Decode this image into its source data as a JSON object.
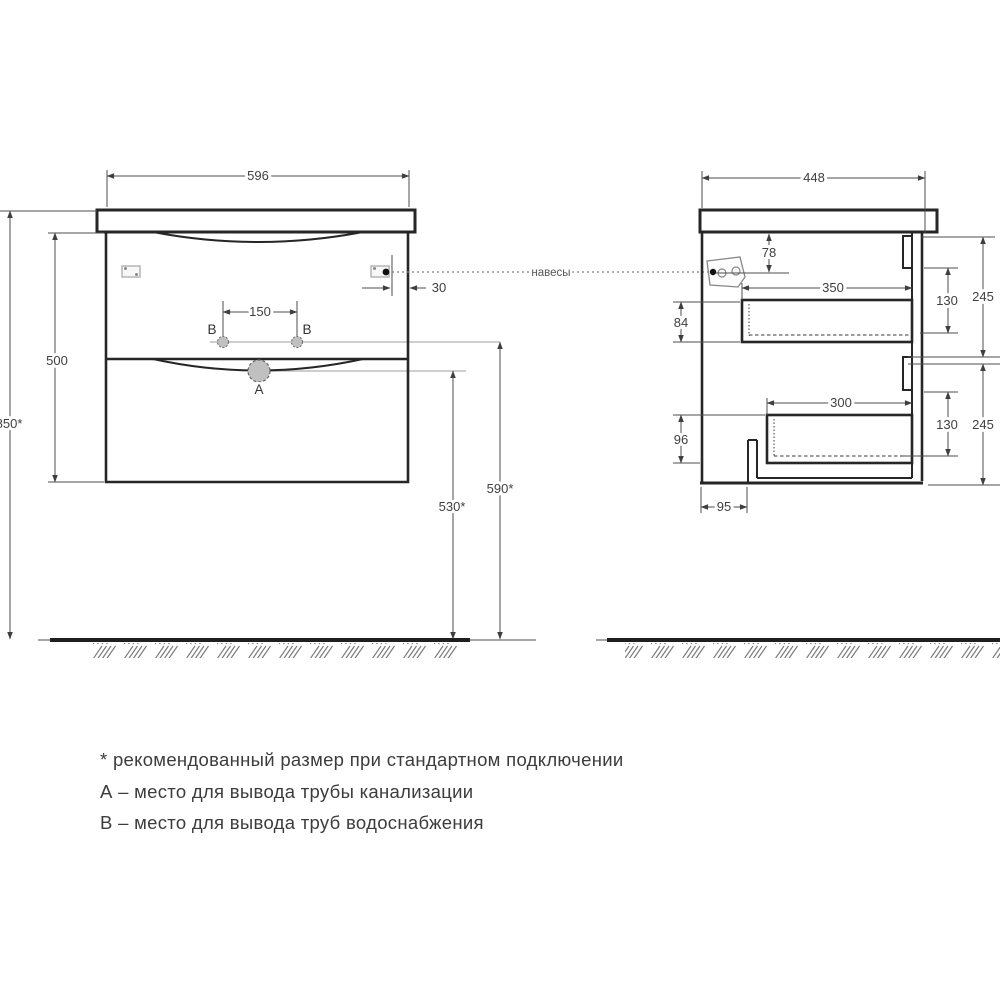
{
  "drawing": {
    "hangers_label": "навесы",
    "front_view": {
      "width": "596",
      "cabinet_height": "500",
      "mount_height": "850*",
      "hole_spacing": "150",
      "hanger_offset": "30",
      "drain_height": "530*",
      "supply_height": "590*",
      "point_a": "A",
      "point_b": "B"
    },
    "side_view": {
      "depth": "448",
      "hanger_drop": "78",
      "drawer1_depth": "350",
      "drawer2_depth": "300",
      "clearance_top": "84",
      "clearance_bottom": "96",
      "drawer_inner_height": "130",
      "section_height": "245",
      "plinth_inset": "95"
    },
    "notes": {
      "asterisk": "* рекомендованный размер при стандартном подключении",
      "a": "А – место для вывода трубы канализации",
      "b": "В – место для вывода труб водоснабжения"
    }
  }
}
